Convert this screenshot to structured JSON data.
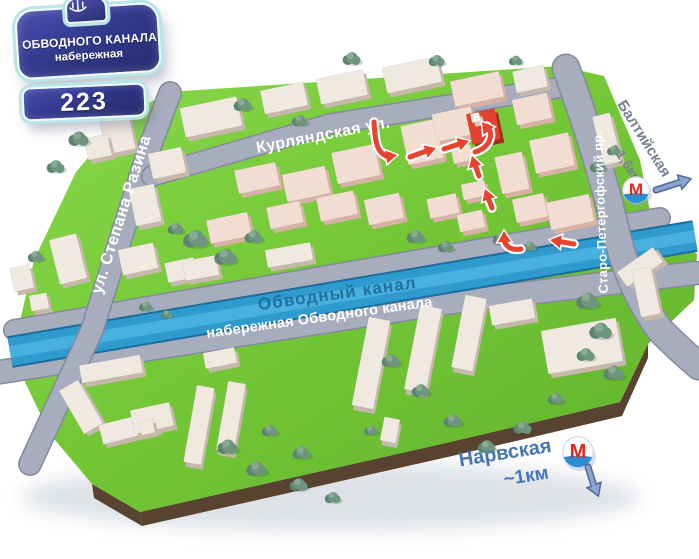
{
  "plate": {
    "title_line1": "ОБВОДНОГО КАНАЛА",
    "title_line2": "набережная",
    "number": "223",
    "emblem_icon": "ship-anchor-emblem"
  },
  "streets": {
    "kurlyandskaya": "Курляндская ул.",
    "stepana_razina": "ул. Степана Разина",
    "canal": "Обводный канал",
    "embankment": "набережная Обводного канала",
    "staro_petergofsky": "Старо-Петергофский пр."
  },
  "metro": {
    "logo_letter": "М",
    "baltiyskaya": {
      "name": "Балтийская",
      "distance": "~1,6км"
    },
    "narvskaya": {
      "name": "Нарвская",
      "distance": "~1км"
    }
  },
  "colors": {
    "grass": "#6cbe31",
    "grass_light": "#85d747",
    "soil": "#57432f",
    "road": "#a8adbe",
    "road_edge": "#83899c",
    "water": "#2f9ace",
    "water_edge": "#1b6d9c",
    "water_sheen": "#5ec2ec",
    "building_top": "#f0e9e0",
    "building_side": "#c6b9ac",
    "building_pink_top": "#f2ddd2",
    "building_pink_side": "#d7b2a4",
    "chimney_top": "#f6f1ea",
    "chimney_side": "#d9d0c5",
    "target_red": "#e2432d",
    "target_red_side": "#a62c1c",
    "route_arrow": "#e8432e",
    "arrow_casing": "#ffffff",
    "tree_dark": "#5d8470",
    "tree_mid": "#6f957f",
    "tree_light": "#87ab94",
    "metro_red": "#e2271f",
    "metro_blue": "#2b8ed2",
    "direction_arrow": "#8ba3cf",
    "direction_arrow_edge": "#4f6795",
    "label_canal": "#1a6898",
    "label_baltiyskaya": "#7a8190",
    "label_narvskaya": "#4676b5"
  },
  "map": {
    "outline": "168,92 560,66 604,76 640,160 652,222 697,254 694,300 648,344 620,402 450,442 140,512 92,484 50,434 24,380 18,330 34,260 76,172 120,120",
    "soil_polys": [
      "140,512 450,442 620,402 648,344 648,358 622,416 452,456 142,526",
      "92,484 140,512 142,526 94,498"
    ],
    "canal": {
      "d": "M10,352 L695,236",
      "w": 28
    },
    "roads": [
      {
        "name": "embankment-upper",
        "d": "M14,330 L660,218",
        "w": 19,
        "layer": "under"
      },
      {
        "name": "embankment-lower",
        "d": "M0,372 L445,303 L695,273",
        "w": 22,
        "layer": "under"
      },
      {
        "name": "stepana-razina",
        "d": "M170,93 L148,152 L92,330 L30,464",
        "w": 21,
        "layer": "over"
      },
      {
        "name": "kurlyandskaya",
        "d": "M152,176 L330,124 L575,85",
        "w": 19,
        "layer": "over"
      },
      {
        "name": "staro-petergofsky",
        "d": "M566,68 Q600,160 618,240 Q632,292 660,330 Q682,352 699,366",
        "w": 26,
        "layer": "over"
      }
    ],
    "buildings": [
      [
        102,
        112,
        30,
        40,
        -12,
        "a"
      ],
      [
        86,
        136,
        24,
        22,
        -12,
        "a"
      ],
      [
        54,
        236,
        28,
        46,
        -14,
        "a"
      ],
      [
        12,
        266,
        20,
        24,
        -12,
        "a"
      ],
      [
        30,
        294,
        18,
        16,
        -10,
        "a"
      ],
      [
        182,
        102,
        58,
        30,
        -12,
        "a"
      ],
      [
        150,
        150,
        34,
        26,
        -12,
        "a"
      ],
      [
        132,
        186,
        26,
        38,
        -12,
        "a"
      ],
      [
        262,
        86,
        44,
        24,
        -12,
        "a"
      ],
      [
        318,
        74,
        48,
        26,
        -12,
        "a"
      ],
      [
        384,
        62,
        56,
        26,
        -12,
        "a"
      ],
      [
        452,
        76,
        50,
        26,
        -12,
        "b"
      ],
      [
        514,
        68,
        32,
        22,
        -12,
        "a"
      ],
      [
        598,
        114,
        18,
        50,
        -14,
        "a"
      ],
      [
        236,
        166,
        42,
        24,
        -12,
        "b"
      ],
      [
        284,
        170,
        44,
        28,
        -12,
        "b"
      ],
      [
        334,
        148,
        44,
        32,
        -12,
        "b"
      ],
      [
        404,
        122,
        36,
        40,
        -12,
        "b"
      ],
      [
        434,
        110,
        40,
        28,
        -12,
        "b"
      ],
      [
        469,
        111,
        29,
        31,
        -12,
        "r"
      ],
      [
        471,
        113,
        9,
        9,
        -12,
        "w"
      ],
      [
        514,
        96,
        36,
        26,
        -12,
        "b"
      ],
      [
        532,
        136,
        40,
        34,
        -12,
        "b"
      ],
      [
        498,
        154,
        28,
        38,
        -12,
        "b"
      ],
      [
        452,
        146,
        20,
        16,
        -12,
        "b"
      ],
      [
        428,
        196,
        30,
        20,
        -12,
        "b"
      ],
      [
        462,
        182,
        24,
        16,
        -12,
        "b"
      ],
      [
        458,
        212,
        26,
        18,
        -12,
        "b"
      ],
      [
        514,
        196,
        32,
        24,
        -12,
        "b"
      ],
      [
        366,
        196,
        36,
        26,
        -12,
        "b"
      ],
      [
        318,
        194,
        38,
        24,
        -12,
        "b"
      ],
      [
        268,
        204,
        34,
        22,
        -12,
        "b"
      ],
      [
        208,
        216,
        42,
        24,
        -12,
        "b"
      ],
      [
        120,
        246,
        36,
        26,
        -12,
        "a"
      ],
      [
        166,
        260,
        30,
        20,
        -12,
        "a"
      ],
      [
        184,
        258,
        34,
        20,
        -10,
        "a"
      ],
      [
        266,
        246,
        46,
        18,
        -10,
        "a"
      ],
      [
        548,
        198,
        44,
        28,
        -12,
        "b"
      ],
      [
        70,
        382,
        22,
        50,
        -30,
        "a"
      ],
      [
        100,
        418,
        56,
        20,
        -14,
        "a"
      ],
      [
        132,
        406,
        40,
        24,
        -12,
        "a"
      ],
      [
        80,
        360,
        62,
        18,
        -10,
        "a"
      ],
      [
        204,
        350,
        32,
        16,
        -11,
        "a"
      ],
      [
        190,
        386,
        18,
        78,
        10,
        "a"
      ],
      [
        222,
        382,
        18,
        70,
        10,
        "a"
      ],
      [
        140,
        420,
        14,
        14,
        -12,
        "a"
      ],
      [
        360,
        318,
        22,
        90,
        11,
        "a"
      ],
      [
        412,
        306,
        22,
        86,
        11,
        "a"
      ],
      [
        458,
        296,
        22,
        74,
        11,
        "a"
      ],
      [
        382,
        418,
        16,
        24,
        11,
        "a"
      ],
      [
        544,
        324,
        76,
        44,
        -10,
        "a"
      ],
      [
        490,
        302,
        44,
        20,
        -10,
        "a"
      ],
      [
        618,
        258,
        44,
        18,
        -35,
        "a"
      ],
      [
        636,
        268,
        20,
        48,
        -12,
        "a"
      ]
    ],
    "trees": [
      [
        79,
        138,
        9
      ],
      [
        56,
        166,
        8
      ],
      [
        36,
        256,
        7
      ],
      [
        243,
        104,
        8
      ],
      [
        300,
        120,
        7
      ],
      [
        352,
        58,
        8
      ],
      [
        437,
        60,
        7
      ],
      [
        516,
        60,
        6
      ],
      [
        196,
        238,
        11
      ],
      [
        226,
        256,
        10
      ],
      [
        254,
        236,
        8
      ],
      [
        176,
        228,
        7
      ],
      [
        416,
        236,
        8
      ],
      [
        446,
        246,
        7
      ],
      [
        502,
        238,
        8
      ],
      [
        530,
        246,
        6
      ],
      [
        598,
        166,
        7
      ],
      [
        614,
        150,
        6
      ],
      [
        146,
        306,
        6
      ],
      [
        167,
        314,
        5
      ],
      [
        228,
        446,
        9
      ],
      [
        257,
        468,
        9
      ],
      [
        299,
        484,
        8
      ],
      [
        333,
        497,
        7
      ],
      [
        391,
        360,
        8
      ],
      [
        421,
        390,
        8
      ],
      [
        453,
        420,
        8
      ],
      [
        487,
        446,
        8
      ],
      [
        523,
        427,
        8
      ],
      [
        556,
        398,
        7
      ],
      [
        588,
        300,
        10
      ],
      [
        601,
        330,
        10
      ],
      [
        586,
        354,
        8
      ],
      [
        614,
        372,
        9
      ],
      [
        371,
        430,
        6
      ],
      [
        302,
        452,
        8
      ],
      [
        270,
        430,
        7
      ]
    ],
    "route_arrows": [
      {
        "d": "M374,122 C375,142 377,154 389,157",
        "h": [
          397,
          155
        ],
        "a": -10
      },
      {
        "d": "M410,157 L429,150",
        "h": [
          436,
          148
        ],
        "a": -19
      },
      {
        "d": "M444,149 L462,143",
        "h": [
          469,
          141
        ],
        "a": -17
      },
      {
        "d": "M475,152 C489,148 495,135 487,126",
        "h": [
          482,
          122
        ],
        "a": -127
      },
      {
        "d": "M479,176 L474,162",
        "h": [
          472,
          156
        ],
        "a": -107
      },
      {
        "d": "M492,208 L487,195",
        "h": [
          485,
          189
        ],
        "a": -110
      },
      {
        "d": "M521,249 C510,251 504,245 504,238",
        "h": [
          504,
          231
        ],
        "a": -92
      },
      {
        "d": "M574,244 L557,241",
        "h": [
          550,
          240
        ],
        "a": 189
      }
    ],
    "metro_arrows": [
      {
        "d": "M656,190 L681,182",
        "h": [
          690,
          179
        ],
        "a": -17
      },
      {
        "d": "M588,467 L594,486",
        "h": [
          598,
          495
        ],
        "a": 68
      }
    ]
  }
}
